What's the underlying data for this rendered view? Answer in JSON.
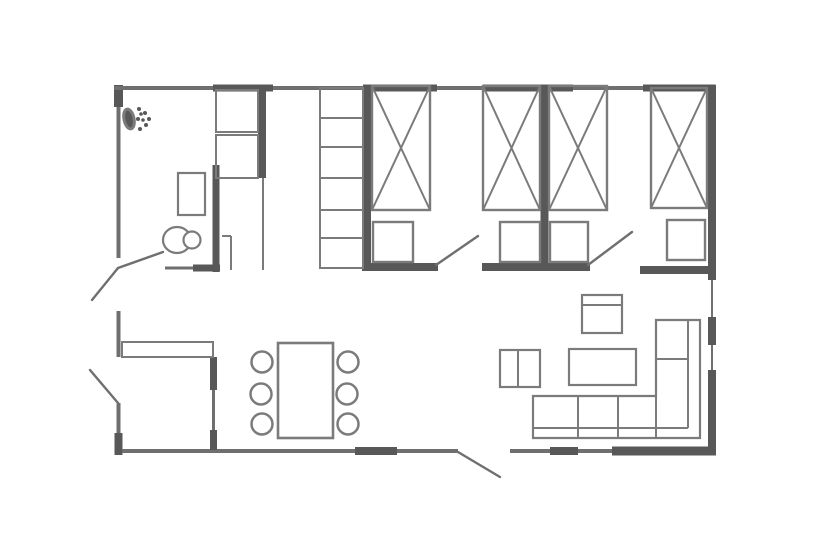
{
  "canvas": {
    "width": 830,
    "height": 555,
    "background": "#ffffff"
  },
  "palette": {
    "dark": "#585858",
    "mid": "#6f6f6f",
    "line": "#7b7b7b",
    "bg": "#ffffff"
  },
  "plan": {
    "walls": [
      {
        "name": "wall-top-left-corner",
        "x1": 118.5,
        "y1": 85,
        "x2": 118.5,
        "y2": 107,
        "tone": "dark",
        "w": 9
      },
      {
        "name": "wall-left-bathroom",
        "x1": 118.5,
        "y1": 107,
        "x2": 118.5,
        "y2": 258,
        "tone": "mid",
        "w": 4
      },
      {
        "name": "wall-left-mid",
        "x1": 118.5,
        "y1": 311,
        "x2": 118.5,
        "y2": 357,
        "tone": "mid",
        "w": 4
      },
      {
        "name": "wall-left-lower",
        "x1": 118.5,
        "y1": 403,
        "x2": 118.5,
        "y2": 433,
        "tone": "mid",
        "w": 4
      },
      {
        "name": "wall-bottom-left-corner",
        "x1": 118.5,
        "y1": 433,
        "x2": 118.5,
        "y2": 455,
        "tone": "dark",
        "w": 8
      },
      {
        "name": "wall-top-1",
        "x1": 114,
        "y1": 88,
        "x2": 213,
        "y2": 88,
        "tone": "mid",
        "w": 4
      },
      {
        "name": "wall-top-2",
        "x1": 213,
        "y1": 88,
        "x2": 273,
        "y2": 88,
        "tone": "dark",
        "w": 7
      },
      {
        "name": "wall-top-3",
        "x1": 273,
        "y1": 88,
        "x2": 363,
        "y2": 88,
        "tone": "mid",
        "w": 4
      },
      {
        "name": "wall-top-4-window",
        "x1": 363,
        "y1": 88,
        "x2": 437,
        "y2": 88,
        "tone": "dark",
        "w": 7
      },
      {
        "name": "wall-top-5",
        "x1": 437,
        "y1": 88,
        "x2": 483,
        "y2": 88,
        "tone": "mid",
        "w": 4
      },
      {
        "name": "wall-top-6-window",
        "x1": 483,
        "y1": 88,
        "x2": 573,
        "y2": 88,
        "tone": "dark",
        "w": 7
      },
      {
        "name": "wall-top-7",
        "x1": 573,
        "y1": 88,
        "x2": 643,
        "y2": 88,
        "tone": "mid",
        "w": 4
      },
      {
        "name": "wall-top-8-window",
        "x1": 643,
        "y1": 88,
        "x2": 715.5,
        "y2": 88,
        "tone": "dark",
        "w": 7
      },
      {
        "name": "wall-right-upper",
        "x1": 712,
        "y1": 85,
        "x2": 712,
        "y2": 280,
        "tone": "dark",
        "w": 8
      },
      {
        "name": "wall-right-window-1",
        "x1": 712,
        "y1": 280,
        "x2": 712,
        "y2": 317,
        "tone": "mid",
        "w": 2
      },
      {
        "name": "wall-right-pier",
        "x1": 712,
        "y1": 317,
        "x2": 712,
        "y2": 345,
        "tone": "dark",
        "w": 8
      },
      {
        "name": "wall-right-window-2",
        "x1": 712,
        "y1": 345,
        "x2": 712,
        "y2": 370,
        "tone": "mid",
        "w": 2
      },
      {
        "name": "wall-right-lower",
        "x1": 712,
        "y1": 370,
        "x2": 712,
        "y2": 455,
        "tone": "dark",
        "w": 8
      },
      {
        "name": "wall-bottom-1",
        "x1": 122,
        "y1": 451,
        "x2": 355,
        "y2": 451,
        "tone": "mid",
        "w": 4
      },
      {
        "name": "wall-bottom-2-pier",
        "x1": 355,
        "y1": 451,
        "x2": 397,
        "y2": 451,
        "tone": "dark",
        "w": 8
      },
      {
        "name": "wall-bottom-3",
        "x1": 397,
        "y1": 451,
        "x2": 458,
        "y2": 451,
        "tone": "mid",
        "w": 4
      },
      {
        "name": "wall-bottom-4",
        "x1": 510,
        "y1": 451,
        "x2": 550,
        "y2": 451,
        "tone": "mid",
        "w": 4
      },
      {
        "name": "wall-bottom-5-pier",
        "x1": 550,
        "y1": 451,
        "x2": 578,
        "y2": 451,
        "tone": "dark",
        "w": 8
      },
      {
        "name": "wall-bottom-6",
        "x1": 578,
        "y1": 451,
        "x2": 612,
        "y2": 451,
        "tone": "mid",
        "w": 4
      },
      {
        "name": "wall-bottom-7-thick",
        "x1": 612,
        "y1": 451,
        "x2": 716,
        "y2": 451,
        "tone": "dark",
        "w": 9
      },
      {
        "name": "wall-bedroom-a-left",
        "x1": 367,
        "y1": 86,
        "x2": 367,
        "y2": 270,
        "tone": "dark",
        "w": 8
      },
      {
        "name": "wall-bedrooms-divider",
        "x1": 544.5,
        "y1": 86,
        "x2": 544.5,
        "y2": 270,
        "tone": "dark",
        "w": 8
      },
      {
        "name": "wall-bathroom-right",
        "x1": 216,
        "y1": 165,
        "x2": 216,
        "y2": 272,
        "tone": "dark",
        "w": 7
      },
      {
        "name": "wall-closet-right",
        "x1": 262,
        "y1": 88,
        "x2": 262,
        "y2": 178,
        "tone": "dark",
        "w": 8
      },
      {
        "name": "wall-storage-right-edge",
        "x1": 263,
        "y1": 178,
        "x2": 263,
        "y2": 270,
        "tone": "line",
        "w": 2
      },
      {
        "name": "wall-kitchen-partition-1",
        "x1": 213.5,
        "y1": 357,
        "x2": 213.5,
        "y2": 390,
        "tone": "dark",
        "w": 7
      },
      {
        "name": "wall-kitchen-partition-2",
        "x1": 213.5,
        "y1": 390,
        "x2": 213.5,
        "y2": 430,
        "tone": "mid",
        "w": 3
      },
      {
        "name": "wall-kitchen-partition-3",
        "x1": 213.5,
        "y1": 430,
        "x2": 213.5,
        "y2": 450,
        "tone": "dark",
        "w": 7
      },
      {
        "name": "wall-bathroom-bottom-thin",
        "x1": 165,
        "y1": 268,
        "x2": 193,
        "y2": 268,
        "tone": "mid",
        "w": 3
      },
      {
        "name": "wall-bathroom-bottom",
        "x1": 193,
        "y1": 268,
        "x2": 220,
        "y2": 268,
        "tone": "dark",
        "w": 7
      },
      {
        "name": "wall-corridor-a",
        "x1": 362,
        "y1": 267,
        "x2": 438,
        "y2": 267,
        "tone": "dark",
        "w": 8
      },
      {
        "name": "wall-corridor-b",
        "x1": 482,
        "y1": 267,
        "x2": 590,
        "y2": 267,
        "tone": "dark",
        "w": 8
      },
      {
        "name": "wall-corridor-c",
        "x1": 640,
        "y1": 270,
        "x2": 714,
        "y2": 270,
        "tone": "dark",
        "w": 8
      }
    ],
    "doors": [
      {
        "name": "door-bathroom-leaf-out",
        "x1": 118,
        "y1": 268,
        "x2": 92,
        "y2": 300
      },
      {
        "name": "door-bathroom-leaf-in",
        "x1": 118,
        "y1": 268,
        "x2": 163,
        "y2": 252
      },
      {
        "name": "door-kitchen-leaf",
        "x1": 118,
        "y1": 403,
        "x2": 90,
        "y2": 370
      },
      {
        "name": "door-bedroom-a-leaf",
        "x1": 436,
        "y1": 265,
        "x2": 478,
        "y2": 236
      },
      {
        "name": "door-bedroom-b-leaf",
        "x1": 588,
        "y1": 265,
        "x2": 632,
        "y2": 232
      },
      {
        "name": "door-entrance-leaf",
        "x1": 458,
        "y1": 452,
        "x2": 500,
        "y2": 477
      }
    ],
    "furniture": {
      "rects": [
        {
          "name": "bed-1",
          "x": 372,
          "y": 86,
          "w": 58,
          "h": 124,
          "cross": true,
          "sw": 2.4
        },
        {
          "name": "bed-2",
          "x": 483,
          "y": 86,
          "w": 57,
          "h": 124,
          "cross": true,
          "sw": 2.4
        },
        {
          "name": "bed-3",
          "x": 549,
          "y": 86,
          "w": 58,
          "h": 124,
          "cross": true,
          "sw": 2.4
        },
        {
          "name": "bed-4",
          "x": 651,
          "y": 88,
          "w": 56,
          "h": 120,
          "cross": true,
          "sw": 2.4
        },
        {
          "name": "nightstand-1",
          "x": 373,
          "y": 222,
          "w": 40,
          "h": 40,
          "sw": 2.4
        },
        {
          "name": "nightstand-2",
          "x": 500,
          "y": 222,
          "w": 40,
          "h": 40,
          "sw": 2.4
        },
        {
          "name": "nightstand-3",
          "x": 550,
          "y": 222,
          "w": 38,
          "h": 40,
          "sw": 2.4
        },
        {
          "name": "nightstand-4",
          "x": 667,
          "y": 220,
          "w": 38,
          "h": 40,
          "sw": 2.4
        },
        {
          "name": "wardrobe-shelving",
          "x": 320,
          "y": 88,
          "w": 43,
          "h": 180,
          "sw": 2
        },
        {
          "name": "closet-upper-cell",
          "x": 216,
          "y": 90,
          "w": 42,
          "h": 42,
          "sw": 2
        },
        {
          "name": "closet-lower-cell",
          "x": 216,
          "y": 135,
          "w": 42,
          "h": 43,
          "sw": 2
        },
        {
          "name": "kitchen-counter",
          "x": 122,
          "y": 342,
          "w": 91,
          "h": 15,
          "sw": 2
        },
        {
          "name": "bathroom-sink",
          "x": 178,
          "y": 173,
          "w": 27,
          "h": 42,
          "sw": 2.2
        },
        {
          "name": "tv-stand",
          "x": 582,
          "y": 295,
          "w": 40,
          "h": 38,
          "sw": 2.2
        },
        {
          "name": "armchair",
          "x": 500,
          "y": 350,
          "w": 40,
          "h": 37,
          "sw": 2.2
        },
        {
          "name": "coffee-table",
          "x": 569,
          "y": 349,
          "w": 67,
          "h": 36,
          "sw": 2.2
        },
        {
          "name": "dining-table",
          "x": 278,
          "y": 343,
          "w": 55,
          "h": 95,
          "sw": 2.6
        }
      ],
      "lines": [
        {
          "name": "wardrobe-shelf-1",
          "x1": 320,
          "y1": 118,
          "x2": 363,
          "y2": 118
        },
        {
          "name": "wardrobe-shelf-2",
          "x1": 320,
          "y1": 147,
          "x2": 363,
          "y2": 147
        },
        {
          "name": "wardrobe-shelf-3",
          "x1": 320,
          "y1": 178,
          "x2": 363,
          "y2": 178
        },
        {
          "name": "wardrobe-shelf-4",
          "x1": 320,
          "y1": 210,
          "x2": 363,
          "y2": 210
        },
        {
          "name": "wardrobe-shelf-5",
          "x1": 320,
          "y1": 238,
          "x2": 363,
          "y2": 238
        },
        {
          "name": "tv-stand-divider",
          "x1": 582,
          "y1": 305,
          "x2": 622,
          "y2": 305
        },
        {
          "name": "armchair-divider",
          "x1": 518,
          "y1": 350,
          "x2": 518,
          "y2": 387
        },
        {
          "name": "sofa-back-bottom",
          "x1": 533,
          "y1": 428,
          "x2": 688,
          "y2": 428
        },
        {
          "name": "sofa-back-right",
          "x1": 688,
          "y1": 320,
          "x2": 688,
          "y2": 428
        },
        {
          "name": "sofa-seat-divider-1",
          "x1": 578,
          "y1": 396,
          "x2": 578,
          "y2": 438
        },
        {
          "name": "sofa-seat-divider-2",
          "x1": 618,
          "y1": 396,
          "x2": 618,
          "y2": 438
        },
        {
          "name": "sofa-corner-divider",
          "x1": 656,
          "y1": 396,
          "x2": 656,
          "y2": 438
        },
        {
          "name": "sofa-chaise-divider",
          "x1": 656,
          "y1": 359,
          "x2": 688,
          "y2": 359
        },
        {
          "name": "storage-jamb-h",
          "x1": 222,
          "y1": 236,
          "x2": 231,
          "y2": 236
        },
        {
          "name": "storage-jamb-v",
          "x1": 231,
          "y1": 236,
          "x2": 231,
          "y2": 270
        }
      ],
      "paths": [
        {
          "name": "sofa-outline",
          "d": "M533,438 L533,396 L656,396 L656,320 L700,320 L700,438 Z",
          "sw": 2.2
        }
      ],
      "ellipses": [
        {
          "name": "toilet-bowl",
          "cx": 177,
          "cy": 240,
          "rx": 14,
          "ry": 13,
          "sw": 2.2,
          "fill": "bg"
        },
        {
          "name": "shower-head",
          "cx": 129,
          "cy": 119,
          "rx": 5,
          "ry": 10,
          "sw": 3,
          "fill": "dark",
          "rotate": -12
        }
      ],
      "circles": [
        {
          "name": "toilet-tank",
          "cx": 192,
          "cy": 240,
          "r": 8.5,
          "sw": 2.2,
          "fill": "bg"
        },
        {
          "name": "dining-chair-1",
          "cx": 262,
          "cy": 362,
          "r": 10.5,
          "sw": 2.5
        },
        {
          "name": "dining-chair-2",
          "cx": 261,
          "cy": 394,
          "r": 10.5,
          "sw": 2.5
        },
        {
          "name": "dining-chair-3",
          "cx": 262,
          "cy": 424,
          "r": 10.5,
          "sw": 2.5
        },
        {
          "name": "dining-chair-4",
          "cx": 348,
          "cy": 362,
          "r": 10.5,
          "sw": 2.5
        },
        {
          "name": "dining-chair-5",
          "cx": 347,
          "cy": 394,
          "r": 10.5,
          "sw": 2.5
        },
        {
          "name": "dining-chair-6",
          "cx": 348,
          "cy": 424,
          "r": 10.5,
          "sw": 2.5
        }
      ],
      "dots": [
        {
          "name": "shower-spray-dot",
          "cx": 139,
          "cy": 109,
          "r": 2
        },
        {
          "name": "shower-spray-dot",
          "cx": 145,
          "cy": 113,
          "r": 2
        },
        {
          "name": "shower-spray-dot",
          "cx": 149,
          "cy": 119,
          "r": 2
        },
        {
          "name": "shower-spray-dot",
          "cx": 146,
          "cy": 125,
          "r": 2
        },
        {
          "name": "shower-spray-dot",
          "cx": 140,
          "cy": 129,
          "r": 2
        },
        {
          "name": "shower-spray-dot",
          "cx": 138,
          "cy": 119,
          "r": 2
        },
        {
          "name": "shower-spray-dot",
          "cx": 143,
          "cy": 120,
          "r": 1.8
        },
        {
          "name": "shower-spray-dot",
          "cx": 141,
          "cy": 114,
          "r": 1.8
        }
      ]
    }
  }
}
